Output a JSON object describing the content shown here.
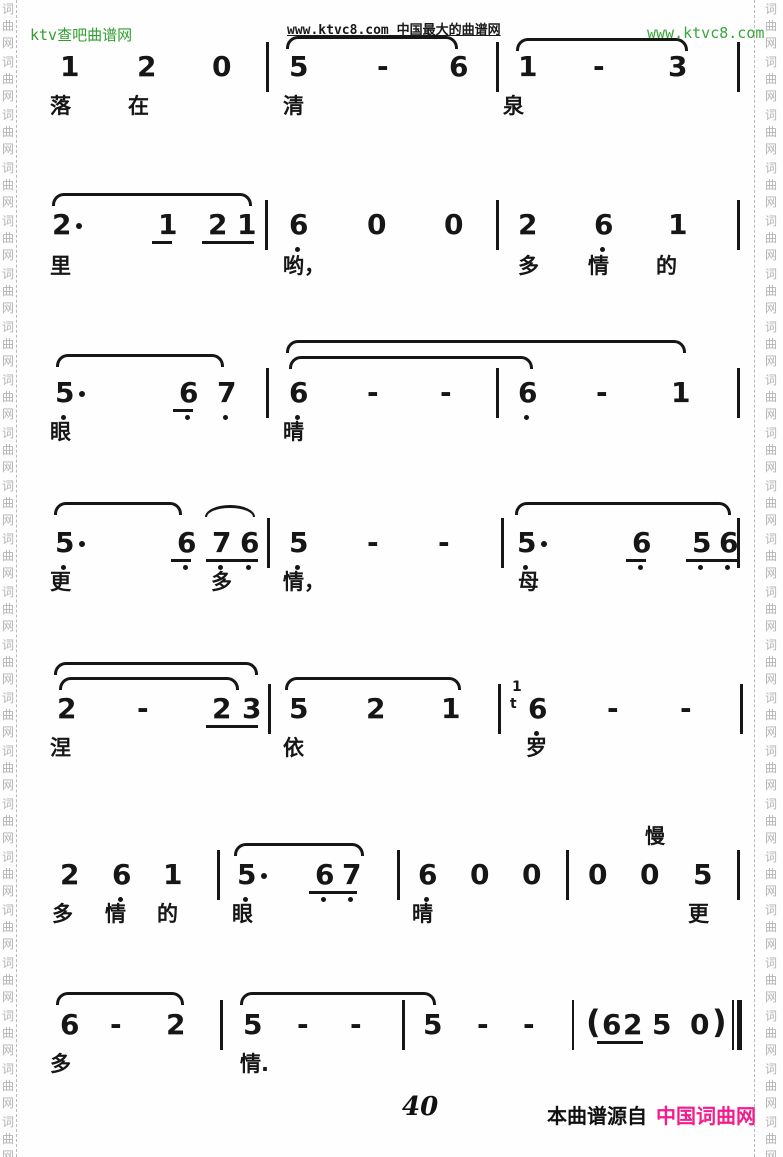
{
  "header": {
    "site_left": "ktv查吧曲谱网",
    "site_center": "www.ktvc8.com 中国最大的曲谱网",
    "site_right": "www.ktvc8.com"
  },
  "footer": {
    "page_number": "40",
    "source_label": "本曲谱源自",
    "source_site": "中国词曲网"
  },
  "colors": {
    "header_green": "#2f9e2f",
    "header_light_green": "#3aa53a",
    "source_pink": "#f21c8d",
    "ink": "#161616",
    "watermark_gray": "#b3b3b3"
  },
  "watermark": {
    "chars": [
      "词",
      "曲",
      "网"
    ],
    "groups": 22,
    "char_step": 17,
    "group_step": 53,
    "start_y": 3,
    "left_x": 2,
    "right_x": 765,
    "dash_left_x": 16,
    "dash_right_x": 754
  },
  "score": {
    "rows": [
      {
        "notes_y": 52,
        "lyrics_y": 94,
        "slurs": [
          {
            "x": 286,
            "w": 172,
            "y": 36,
            "type": "flat"
          },
          {
            "x": 516,
            "w": 172,
            "y": 38,
            "type": "flat"
          }
        ],
        "bars": [
          {
            "x": 266
          },
          {
            "x": 496
          },
          {
            "x": 737
          }
        ],
        "notes": [
          {
            "x": 60,
            "t": "1"
          },
          {
            "x": 137,
            "t": "2"
          },
          {
            "x": 212,
            "t": "0"
          },
          {
            "x": 289,
            "t": "5"
          },
          {
            "x": 377,
            "t": "-"
          },
          {
            "x": 449,
            "t": "6"
          },
          {
            "x": 518,
            "t": "1"
          },
          {
            "x": 593,
            "t": "-"
          },
          {
            "x": 668,
            "t": "3"
          }
        ],
        "beams": [],
        "lyrics": [
          {
            "x": 50,
            "t": "落"
          },
          {
            "x": 128,
            "t": "在"
          },
          {
            "x": 283,
            "t": "清"
          },
          {
            "x": 503,
            "t": "泉"
          }
        ]
      },
      {
        "notes_y": 210,
        "lyrics_y": 254,
        "slurs": [
          {
            "x": 52,
            "w": 200,
            "y": 193,
            "type": "flat"
          }
        ],
        "bars": [
          {
            "x": 265
          },
          {
            "x": 496
          },
          {
            "x": 737
          }
        ],
        "notes": [
          {
            "x": 52,
            "t": "2",
            "dd": true
          },
          {
            "x": 158,
            "t": "1"
          },
          {
            "x": 208,
            "t": "2"
          },
          {
            "x": 237,
            "t": "1"
          },
          {
            "x": 289,
            "t": "6",
            "low": true
          },
          {
            "x": 367,
            "t": "0"
          },
          {
            "x": 444,
            "t": "0"
          },
          {
            "x": 518,
            "t": "2"
          },
          {
            "x": 594,
            "t": "6",
            "low": true
          },
          {
            "x": 668,
            "t": "1"
          }
        ],
        "beams": [
          {
            "x": 152,
            "w": 20
          },
          {
            "x": 202,
            "w": 52
          }
        ],
        "lyrics": [
          {
            "x": 50,
            "t": "里"
          },
          {
            "x": 283,
            "t": "哟，"
          },
          {
            "x": 518,
            "t": "多"
          },
          {
            "x": 588,
            "t": "情"
          },
          {
            "x": 656,
            "t": "的"
          }
        ]
      },
      {
        "notes_y": 378,
        "lyrics_y": 420,
        "slurs": [
          {
            "x": 56,
            "w": 168,
            "y": 354,
            "type": "flat"
          },
          {
            "x": 286,
            "w": 400,
            "y": 340,
            "type": "flat"
          },
          {
            "x": 289,
            "w": 244,
            "y": 356,
            "type": "flat"
          }
        ],
        "bars": [
          {
            "x": 266
          },
          {
            "x": 496
          },
          {
            "x": 737
          }
        ],
        "notes": [
          {
            "x": 55,
            "t": "5",
            "low": true,
            "dd": true
          },
          {
            "x": 179,
            "t": "6",
            "low": true
          },
          {
            "x": 217,
            "t": "7",
            "low": true
          },
          {
            "x": 289,
            "t": "6",
            "low": true
          },
          {
            "x": 367,
            "t": "-"
          },
          {
            "x": 440,
            "t": "-"
          },
          {
            "x": 518,
            "t": "6",
            "low": true
          },
          {
            "x": 596,
            "t": "-"
          },
          {
            "x": 671,
            "t": "1"
          }
        ],
        "beams": [
          {
            "x": 173,
            "w": 20
          }
        ],
        "lyrics": [
          {
            "x": 50,
            "t": "眼"
          },
          {
            "x": 283,
            "t": "晴"
          }
        ]
      },
      {
        "notes_y": 528,
        "lyrics_y": 570,
        "slurs": [
          {
            "x": 54,
            "w": 128,
            "y": 502,
            "type": "flat"
          },
          {
            "x": 205,
            "w": 50,
            "y": 505,
            "type": "arc"
          },
          {
            "x": 515,
            "w": 216,
            "y": 502,
            "type": "flat"
          }
        ],
        "bars": [
          {
            "x": 267
          },
          {
            "x": 501
          },
          {
            "x": 737
          }
        ],
        "notes": [
          {
            "x": 55,
            "t": "5",
            "low": true,
            "dd": true
          },
          {
            "x": 177,
            "t": "6",
            "low": true
          },
          {
            "x": 212,
            "t": "7",
            "low": true
          },
          {
            "x": 240,
            "t": "6",
            "low": true
          },
          {
            "x": 289,
            "t": "5",
            "low": true
          },
          {
            "x": 367,
            "t": "-"
          },
          {
            "x": 438,
            "t": "-"
          },
          {
            "x": 517,
            "t": "5",
            "low": true,
            "dd": true
          },
          {
            "x": 632,
            "t": "6",
            "low": true
          },
          {
            "x": 692,
            "t": "5",
            "low": true
          },
          {
            "x": 719,
            "t": "6",
            "low": true
          }
        ],
        "beams": [
          {
            "x": 171,
            "w": 20
          },
          {
            "x": 206,
            "w": 52
          },
          {
            "x": 626,
            "w": 20
          },
          {
            "x": 686,
            "w": 52
          }
        ],
        "lyrics": [
          {
            "x": 50,
            "t": "更"
          },
          {
            "x": 211,
            "t": "多"
          },
          {
            "x": 283,
            "t": "情，"
          },
          {
            "x": 518,
            "t": "母"
          }
        ]
      },
      {
        "notes_y": 694,
        "lyrics_y": 736,
        "slurs": [
          {
            "x": 54,
            "w": 204,
            "y": 662,
            "type": "flat"
          },
          {
            "x": 59,
            "w": 180,
            "y": 677,
            "type": "flat"
          },
          {
            "x": 285,
            "w": 176,
            "y": 677,
            "type": "flat"
          }
        ],
        "bars": [
          {
            "x": 268
          },
          {
            "x": 498
          },
          {
            "x": 740
          }
        ],
        "notes": [
          {
            "x": 57,
            "t": "2"
          },
          {
            "x": 137,
            "t": "-"
          },
          {
            "x": 212,
            "t": "2"
          },
          {
            "x": 242,
            "t": "3"
          },
          {
            "x": 289,
            "t": "5"
          },
          {
            "x": 366,
            "t": "2"
          },
          {
            "x": 441,
            "t": "1"
          },
          {
            "x": 512,
            "t": "1",
            "grace": true,
            "dy": -14
          },
          {
            "x": 510,
            "t": "t",
            "grace": true,
            "dy": 3
          },
          {
            "x": 528,
            "t": "6",
            "low": true
          },
          {
            "x": 607,
            "t": "-"
          },
          {
            "x": 680,
            "t": "-"
          }
        ],
        "beams": [
          {
            "x": 206,
            "w": 52
          }
        ],
        "lyrics": [
          {
            "x": 50,
            "t": "涅"
          },
          {
            "x": 283,
            "t": "依"
          },
          {
            "x": 526,
            "t": "罗"
          }
        ]
      },
      {
        "notes_y": 860,
        "lyrics_y": 902,
        "annotations": [
          {
            "x": 645,
            "y": 820,
            "t": "慢"
          }
        ],
        "slurs": [
          {
            "x": 234,
            "w": 130,
            "y": 843,
            "type": "flat"
          }
        ],
        "bars": [
          {
            "x": 217
          },
          {
            "x": 397
          },
          {
            "x": 566
          },
          {
            "x": 737
          }
        ],
        "notes": [
          {
            "x": 60,
            "t": "2"
          },
          {
            "x": 112,
            "t": "6",
            "low": true
          },
          {
            "x": 163,
            "t": "1"
          },
          {
            "x": 237,
            "t": "5",
            "low": true,
            "dd": true
          },
          {
            "x": 315,
            "t": "6",
            "low": true
          },
          {
            "x": 342,
            "t": "7",
            "low": true
          },
          {
            "x": 418,
            "t": "6",
            "low": true
          },
          {
            "x": 470,
            "t": "0"
          },
          {
            "x": 522,
            "t": "0"
          },
          {
            "x": 588,
            "t": "0"
          },
          {
            "x": 640,
            "t": "0"
          },
          {
            "x": 693,
            "t": "5"
          }
        ],
        "beams": [
          {
            "x": 309,
            "w": 48
          }
        ],
        "lyrics": [
          {
            "x": 52,
            "t": "多"
          },
          {
            "x": 105,
            "t": "情"
          },
          {
            "x": 157,
            "t": "的"
          },
          {
            "x": 232,
            "t": "眼"
          },
          {
            "x": 412,
            "t": "晴"
          },
          {
            "x": 688,
            "t": "更"
          }
        ]
      },
      {
        "notes_y": 1010,
        "lyrics_y": 1052,
        "slurs": [
          {
            "x": 56,
            "w": 128,
            "y": 992,
            "type": "flat"
          },
          {
            "x": 240,
            "w": 196,
            "y": 992,
            "type": "flat"
          }
        ],
        "bars": [
          {
            "x": 220
          },
          {
            "x": 402
          },
          {
            "x": 572,
            "thin": true
          },
          {
            "x": 732,
            "thin": true
          },
          {
            "x": 737,
            "thick": true
          }
        ],
        "notes": [
          {
            "x": 60,
            "t": "6"
          },
          {
            "x": 110,
            "t": "-"
          },
          {
            "x": 166,
            "t": "2"
          },
          {
            "x": 243,
            "t": "5"
          },
          {
            "x": 297,
            "t": "-"
          },
          {
            "x": 350,
            "t": "-"
          },
          {
            "x": 423,
            "t": "5"
          },
          {
            "x": 477,
            "t": "-"
          },
          {
            "x": 523,
            "t": "-"
          },
          {
            "x": 586,
            "t": "(",
            "paren": true,
            "dy": -3
          },
          {
            "x": 602,
            "t": "6"
          },
          {
            "x": 623,
            "t": "2"
          },
          {
            "x": 652,
            "t": "5"
          },
          {
            "x": 690,
            "t": "0"
          },
          {
            "x": 712,
            "t": ")",
            "paren": true,
            "dy": -3
          }
        ],
        "beams": [
          {
            "x": 597,
            "w": 46
          }
        ],
        "lyrics": [
          {
            "x": 50,
            "t": "多"
          },
          {
            "x": 240,
            "t": "情."
          }
        ]
      }
    ]
  }
}
